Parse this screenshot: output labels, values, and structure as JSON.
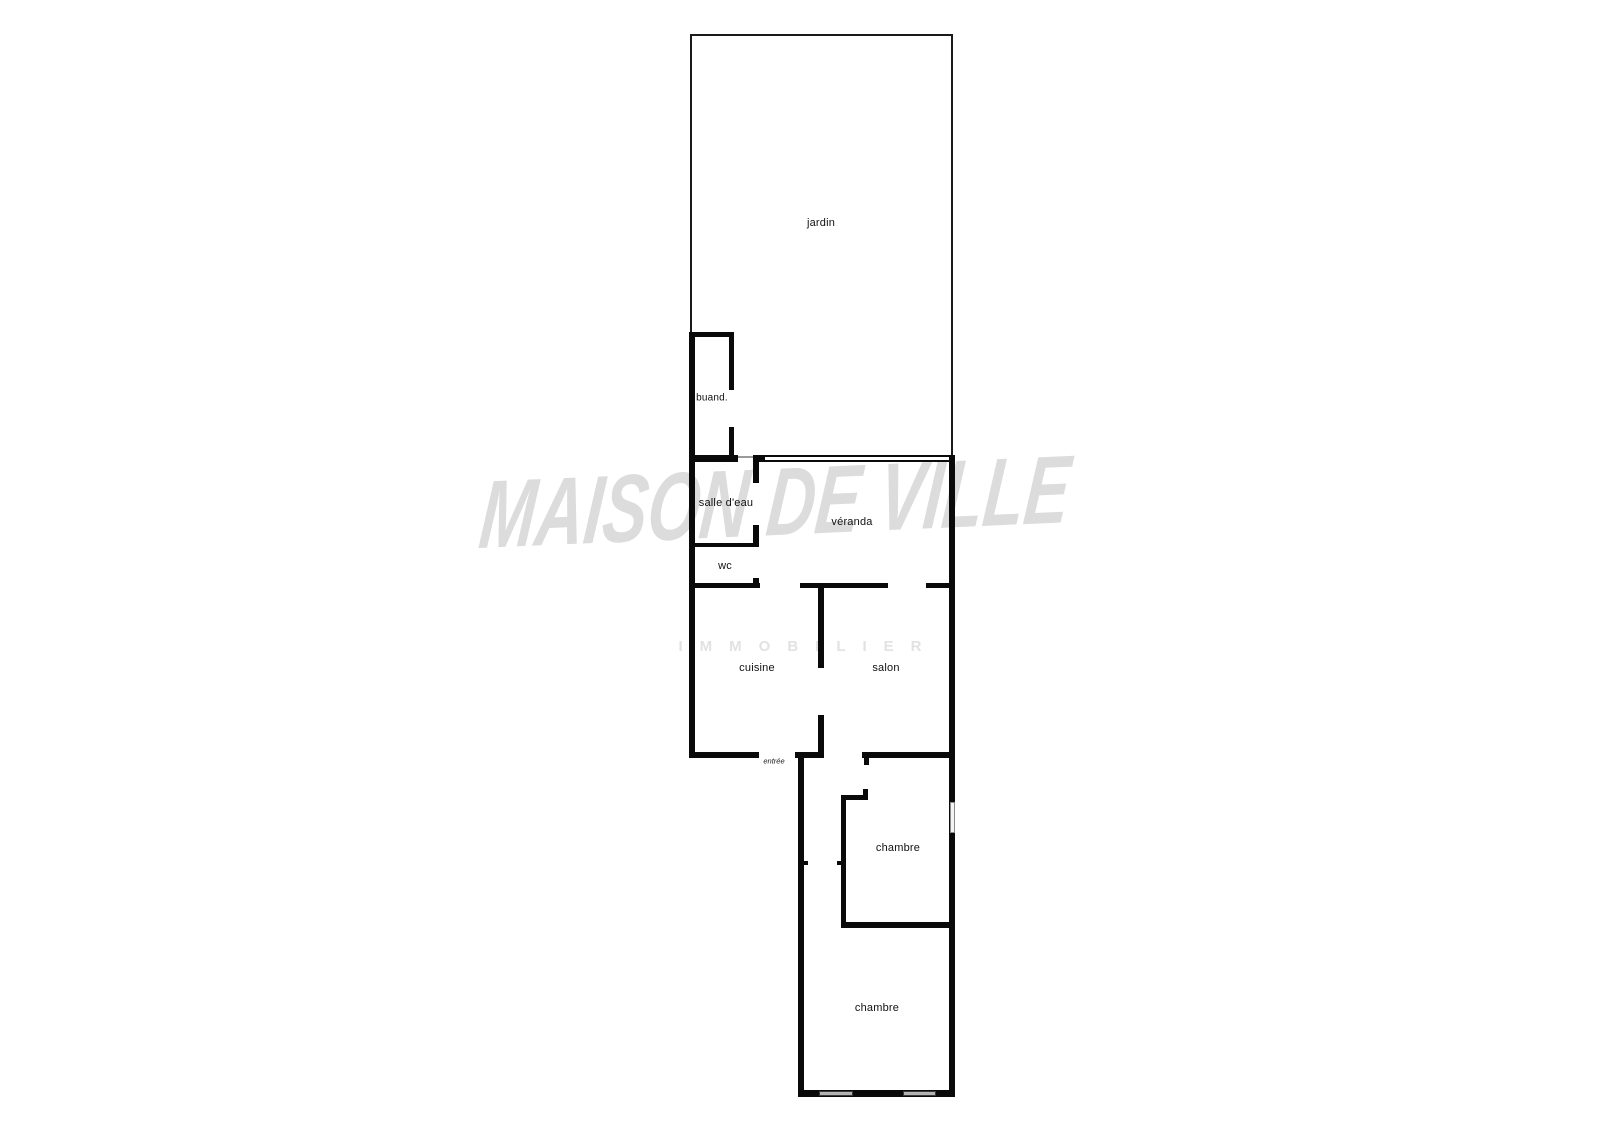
{
  "plan": {
    "rooms": {
      "jardin": "jardin",
      "buanderie": "buand.",
      "salle_deau": "salle d'eau",
      "wc": "wc",
      "veranda": "véranda",
      "cuisine": "cuisine",
      "salon": "salon",
      "entree": "entrée",
      "chambre1": "chambre",
      "chambre2": "chambre"
    }
  },
  "watermark": {
    "title": "MAISON DE VILLE",
    "subtitle": "IMMOBILIER"
  },
  "colors": {
    "wall": "#0a0a0a",
    "fence": "#1a1a1a",
    "threshold": "#9a9a9a",
    "window_fill": "#b3b3b3",
    "watermark": "#dcdcdc",
    "watermark_sub": "#e2e2e2"
  }
}
